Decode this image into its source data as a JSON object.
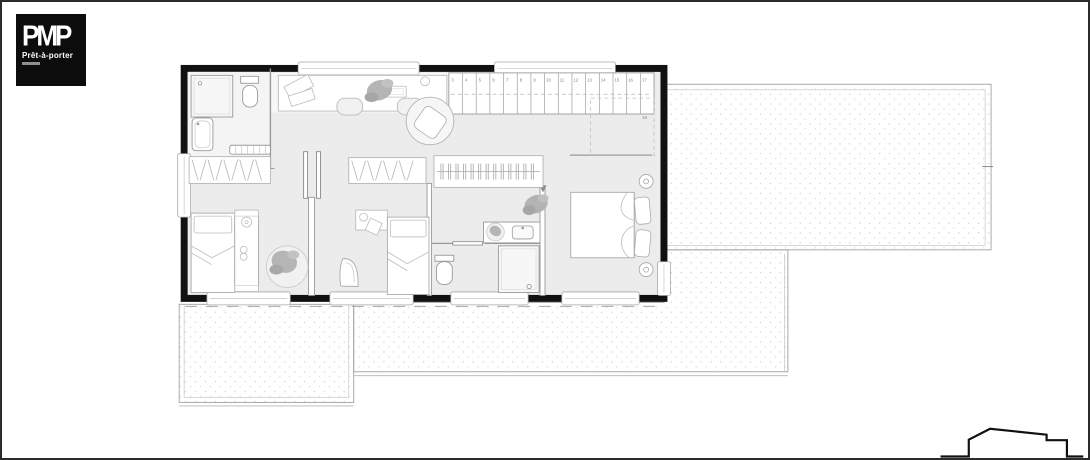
{
  "logo": {
    "brand": "PMP",
    "tagline": "Prêt-à-porter"
  },
  "plan": {
    "type": "architectural-floor-plan-upper-level",
    "stairs": {
      "treads": [
        "3",
        "4",
        "5",
        "6",
        "7",
        "8",
        "9",
        "10",
        "11",
        "12",
        "13",
        "14",
        "15",
        "16",
        "17"
      ],
      "landing": "18"
    }
  },
  "colors": {
    "frame": "#2b2b2b",
    "wall": "#111111",
    "floor": "#ececec",
    "furniture_line": "#9a9a9a",
    "terrace_dot": "#d4d4d4",
    "plant": "#b5b5b5",
    "logo_bg": "#0c0c0c",
    "logo_text": "#ffffff"
  }
}
